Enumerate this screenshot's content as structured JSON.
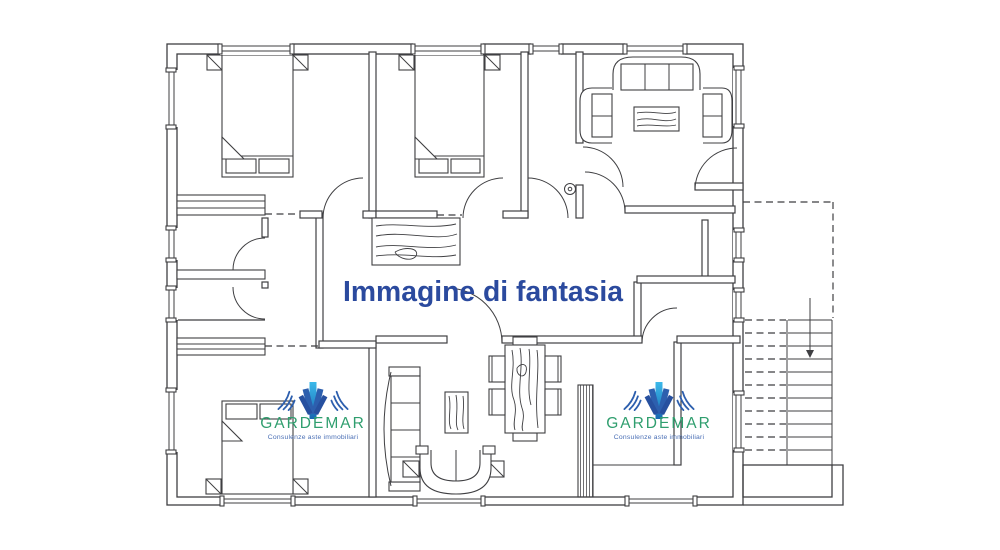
{
  "image": {
    "kind": "apartment floor plan drawing",
    "background": "#ffffff",
    "line_color": "#3f3f42"
  },
  "watermark": {
    "text": "Immagine di fantasia",
    "color": "#2b4a9e"
  },
  "logos": {
    "brand": "GARDEMAR",
    "tagline": "Consulenze aste immobiliari",
    "brand_color": "#2f9e6e",
    "tagline_color": "#4a6fb5",
    "beam_cyan": "#3cb9ea",
    "beam_blue": "#2d5fae",
    "instances": [
      {
        "position": "bottom-left"
      },
      {
        "position": "bottom-right"
      }
    ]
  },
  "staircase": {
    "icon": "down-arrow-icon"
  }
}
